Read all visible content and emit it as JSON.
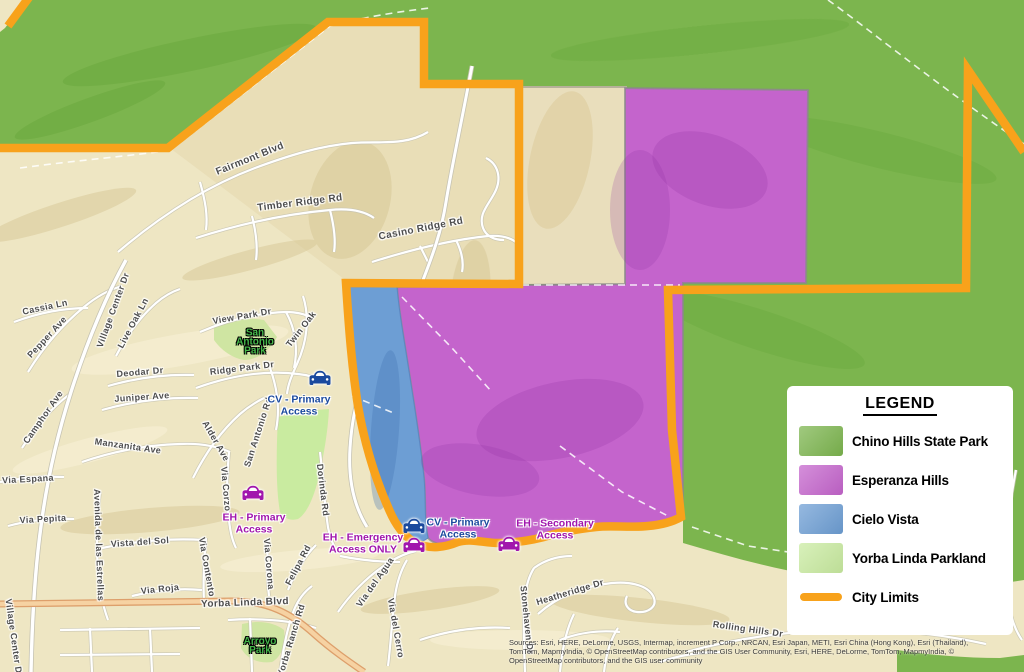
{
  "colors": {
    "map_tan": "#eee6c3",
    "map_tan_dark": "#e3d6ac",
    "chino_green": "#7cb54e",
    "esperanza_purple": "#c464cc",
    "cielo_blue": "#6d9ed4",
    "parkland_green": "#c9eba0",
    "city_orange": "#f8a21b",
    "street_gray": "#4d4d4d",
    "park_green": "#43b649",
    "access_blue": "#1b4a9e",
    "access_purple": "#a116ad",
    "road_white": "#ffffff",
    "ylb_fill": "#f6d2a2",
    "ylb_casing": "#dd9f6b"
  },
  "legend": {
    "title": "LEGEND",
    "items": [
      {
        "label": "Chino Hills State Park",
        "swatch": "#7cb54e",
        "type": "fill"
      },
      {
        "label": "Esperanza Hills",
        "swatch": "#c464cc",
        "type": "fill"
      },
      {
        "label": "Cielo Vista",
        "swatch": "#6d9ed4",
        "type": "fill"
      },
      {
        "label": "Yorba Linda Parkland",
        "swatch": "#c9eba0",
        "type": "fill"
      },
      {
        "label": "City Limits",
        "swatch": "#f8a21b",
        "type": "line"
      }
    ]
  },
  "map": {
    "street_labels": [
      {
        "text": "Fairmont Blvd",
        "x": 250,
        "y": 159,
        "rot": -22,
        "size": 10
      },
      {
        "text": "Timber Ridge Rd",
        "x": 300,
        "y": 203,
        "rot": -7,
        "size": 10
      },
      {
        "text": "Casino Ridge Rd",
        "x": 421,
        "y": 229,
        "rot": -11,
        "size": 10
      },
      {
        "text": "View Park Dr",
        "x": 242,
        "y": 316,
        "rot": -10,
        "size": 9
      },
      {
        "text": "Twin Oak",
        "x": 301,
        "y": 329,
        "rot": -52,
        "size": 9
      },
      {
        "text": "Ridge Park Dr",
        "x": 242,
        "y": 368,
        "rot": -7,
        "size": 9
      },
      {
        "text": "San Antonio Rd",
        "x": 258,
        "y": 432,
        "rot": -72,
        "size": 9
      },
      {
        "text": "Alder Ave",
        "x": 216,
        "y": 441,
        "rot": 60,
        "size": 9
      },
      {
        "text": "Via Corzo",
        "x": 226,
        "y": 489,
        "rot": 85,
        "size": 9
      },
      {
        "text": "Dorinda Rd",
        "x": 323,
        "y": 490,
        "rot": 83,
        "size": 9
      },
      {
        "text": "Cassia Ln",
        "x": 45,
        "y": 307,
        "rot": -12,
        "size": 9
      },
      {
        "text": "Pepper Ave",
        "x": 47,
        "y": 337,
        "rot": -47,
        "size": 9
      },
      {
        "text": "Village Center Dr",
        "x": 113,
        "y": 310,
        "rot": -70,
        "size": 9
      },
      {
        "text": "Live Oak Ln",
        "x": 133,
        "y": 323,
        "rot": -62,
        "size": 9
      },
      {
        "text": "Deodar Dr",
        "x": 140,
        "y": 372,
        "rot": -5,
        "size": 9
      },
      {
        "text": "Juniper Ave",
        "x": 142,
        "y": 397,
        "rot": -4,
        "size": 9
      },
      {
        "text": "Camphor Ave",
        "x": 43,
        "y": 417,
        "rot": -55,
        "size": 9
      },
      {
        "text": "Manzanita Ave",
        "x": 128,
        "y": 446,
        "rot": 8,
        "size": 9
      },
      {
        "text": "Via Espana",
        "x": 28,
        "y": 479,
        "rot": -3,
        "size": 9
      },
      {
        "text": "Via Pepita",
        "x": 43,
        "y": 519,
        "rot": -3,
        "size": 9
      },
      {
        "text": "Avenida de las Estrellas",
        "x": 99,
        "y": 545,
        "rot": 88,
        "size": 9
      },
      {
        "text": "Vista del Sol",
        "x": 140,
        "y": 542,
        "rot": -4,
        "size": 9
      },
      {
        "text": "Via Roja",
        "x": 160,
        "y": 589,
        "rot": -6,
        "size": 9
      },
      {
        "text": "Via Contento",
        "x": 207,
        "y": 567,
        "rot": 80,
        "size": 9
      },
      {
        "text": "Via Corona",
        "x": 269,
        "y": 564,
        "rot": 85,
        "size": 9
      },
      {
        "text": "Felipa Rd",
        "x": 298,
        "y": 565,
        "rot": -62,
        "size": 9
      },
      {
        "text": "Yorba Linda Blvd",
        "x": 245,
        "y": 603,
        "rot": -2,
        "size": 10
      },
      {
        "text": "Village Center Dr",
        "x": 14,
        "y": 638,
        "rot": 82,
        "size": 9
      },
      {
        "text": "Via del Agua",
        "x": 375,
        "y": 582,
        "rot": -55,
        "size": 9
      },
      {
        "text": "Via del Cerro",
        "x": 396,
        "y": 628,
        "rot": 80,
        "size": 9
      },
      {
        "text": "Stonehaven Dr",
        "x": 527,
        "y": 620,
        "rot": 84,
        "size": 9
      },
      {
        "text": "Heatheridge Dr",
        "x": 570,
        "y": 592,
        "rot": -17,
        "size": 9
      },
      {
        "text": "Rolling Hills Dr",
        "x": 748,
        "y": 629,
        "rot": 8,
        "size": 9
      },
      {
        "text": "Yorba Ranch Rd",
        "x": 291,
        "y": 640,
        "rot": -73,
        "size": 9
      }
    ],
    "park_labels": [
      {
        "line1": "San",
        "line2": "Antonio",
        "line3": "Park",
        "x": 255,
        "y": 342
      },
      {
        "line1": "Arroyo",
        "line2": "Park",
        "x": 260,
        "y": 646
      }
    ],
    "access_labels": [
      {
        "line1": "CV - Primary",
        "line2": "Access",
        "color": "#1b4a9e",
        "x": 299,
        "y": 406
      },
      {
        "line1": "EH - Primary",
        "line2": "Access",
        "color": "#a116ad",
        "x": 254,
        "y": 524
      },
      {
        "line1": "EH - Emergency",
        "line2": "Access ONLY",
        "color": "#a116ad",
        "x": 363,
        "y": 544
      },
      {
        "line1": "CV - Primary",
        "line2": "Access",
        "color": "#1b4a9e",
        "x": 458,
        "y": 529
      },
      {
        "line1": "EH - Secondary",
        "line2": "Access",
        "color": "#a116ad",
        "x": 555,
        "y": 530
      }
    ],
    "car_icons": [
      {
        "color": "#1b4a9e",
        "x": 320,
        "y": 379
      },
      {
        "color": "#a116ad",
        "x": 253,
        "y": 494
      },
      {
        "color": "#1b4a9e",
        "x": 414,
        "y": 527
      },
      {
        "color": "#a116ad",
        "x": 414,
        "y": 546
      },
      {
        "color": "#a116ad",
        "x": 509,
        "y": 545
      }
    ]
  },
  "sources": {
    "lines": [
      "Sources: Esri, HERE, DeLorme, USGS, Intermap, increment P Corp., NRCAN, Esri Japan, METI, Esri China (Hong Kong), Esri (Thailand),",
      "TomTom, MapmyIndia, © OpenStreetMap contributors, and the GIS User Community, Esri, HERE, DeLorme, TomTom, MapmyIndia, ©",
      "OpenStreetMap contributors, and the GIS user community"
    ]
  }
}
